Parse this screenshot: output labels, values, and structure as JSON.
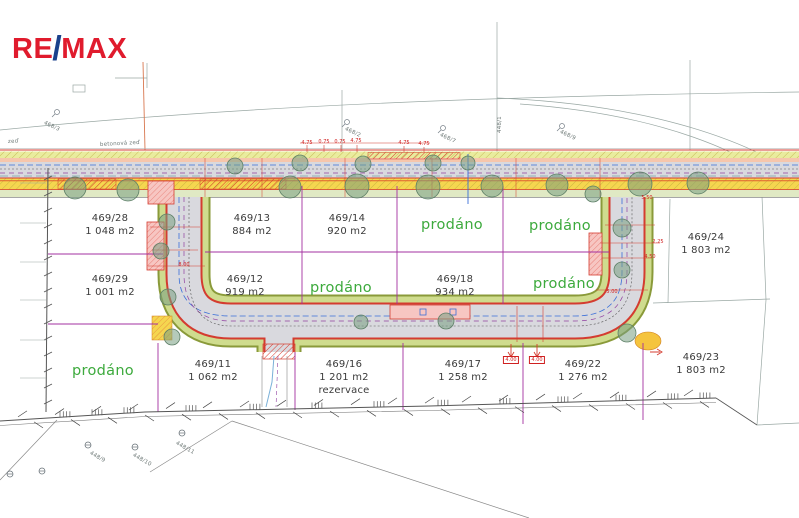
{
  "page": {
    "background": "#ffffff"
  },
  "logo": {
    "re": "RE",
    "slash": "/",
    "max": "MAX"
  },
  "colors": {
    "remax_red": "#e01b2d",
    "remax_blue": "#1b418c",
    "sold_green": "#3daa3d",
    "parcel_text": "#3a3a3a",
    "boundary_magenta": "#a330a0",
    "curb_red": "#d43c30",
    "dimension_red": "#d02020",
    "road_gray": "#d9d9de",
    "verge_green": "#cfdc8e"
  },
  "parcels": [
    {
      "id": "469/28",
      "area": "1 048 m2",
      "x": 110,
      "y": 212
    },
    {
      "id": "469/13",
      "area": "884 m2",
      "x": 252,
      "y": 212
    },
    {
      "id": "469/14",
      "area": "920 m2",
      "x": 347,
      "y": 212
    },
    {
      "id": "469/24",
      "area": "1 803 m2",
      "x": 706,
      "y": 231
    },
    {
      "id": "469/29",
      "area": "1 001 m2",
      "x": 110,
      "y": 273
    },
    {
      "id": "469/12",
      "area": "919 m2",
      "x": 245,
      "y": 273
    },
    {
      "id": "469/18",
      "area": "934 m2",
      "x": 455,
      "y": 273
    },
    {
      "id": "469/11",
      "area": "1 062 m2",
      "x": 213,
      "y": 358
    },
    {
      "id": "469/16",
      "area": "1 201 m2",
      "note": "rezervace",
      "x": 344,
      "y": 358
    },
    {
      "id": "469/17",
      "area": "1 258 m2",
      "x": 463,
      "y": 358
    },
    {
      "id": "469/22",
      "area": "1 276 m2",
      "x": 583,
      "y": 358
    },
    {
      "id": "469/23",
      "area": "1 803 m2",
      "x": 701,
      "y": 351
    }
  ],
  "sold": {
    "text": "prodáno",
    "positions": [
      {
        "x": 452,
        "y": 225
      },
      {
        "x": 560,
        "y": 226
      },
      {
        "x": 341,
        "y": 288
      },
      {
        "x": 564,
        "y": 284
      },
      {
        "x": 103,
        "y": 371
      }
    ]
  },
  "bg_labels": [
    {
      "text": "468/3",
      "x": 44,
      "y": 120,
      "rot": 25
    },
    {
      "text": "468/2",
      "x": 345,
      "y": 126,
      "rot": 25
    },
    {
      "text": "468/7",
      "x": 440,
      "y": 132,
      "rot": 25
    },
    {
      "text": "448/1",
      "x": 500,
      "y": 130,
      "rot": -90
    },
    {
      "text": "468/9",
      "x": 560,
      "y": 129,
      "rot": 25
    },
    {
      "text": "betonová zeď",
      "x": 100,
      "y": 142,
      "rot": -3
    },
    {
      "text": "zeď",
      "x": 8,
      "y": 139,
      "rot": -3
    },
    {
      "text": "448/9",
      "x": 90,
      "y": 450,
      "rot": 30
    },
    {
      "text": "448/10",
      "x": 133,
      "y": 452,
      "rot": 30
    },
    {
      "text": "448/11",
      "x": 176,
      "y": 440,
      "rot": 30
    }
  ],
  "dims": [
    {
      "text": "4.75",
      "x": 307,
      "y": 140
    },
    {
      "text": "0.75",
      "x": 324,
      "y": 139
    },
    {
      "text": "0.75",
      "x": 340,
      "y": 139
    },
    {
      "text": "4.75",
      "x": 356,
      "y": 138
    },
    {
      "text": "4.75",
      "x": 404,
      "y": 140
    },
    {
      "text": "4.75",
      "x": 424,
      "y": 141
    },
    {
      "text": "5.50",
      "x": 647,
      "y": 195
    },
    {
      "text": "2.25",
      "x": 658,
      "y": 239
    },
    {
      "text": "4.50",
      "x": 650,
      "y": 254
    },
    {
      "text": "5.00",
      "x": 612,
      "y": 289
    },
    {
      "text": "8.00",
      "x": 184,
      "y": 262
    },
    {
      "text": "4.00",
      "x": 511,
      "y": 356,
      "boxed": true
    },
    {
      "text": "4.00",
      "x": 537,
      "y": 356,
      "boxed": true
    }
  ]
}
